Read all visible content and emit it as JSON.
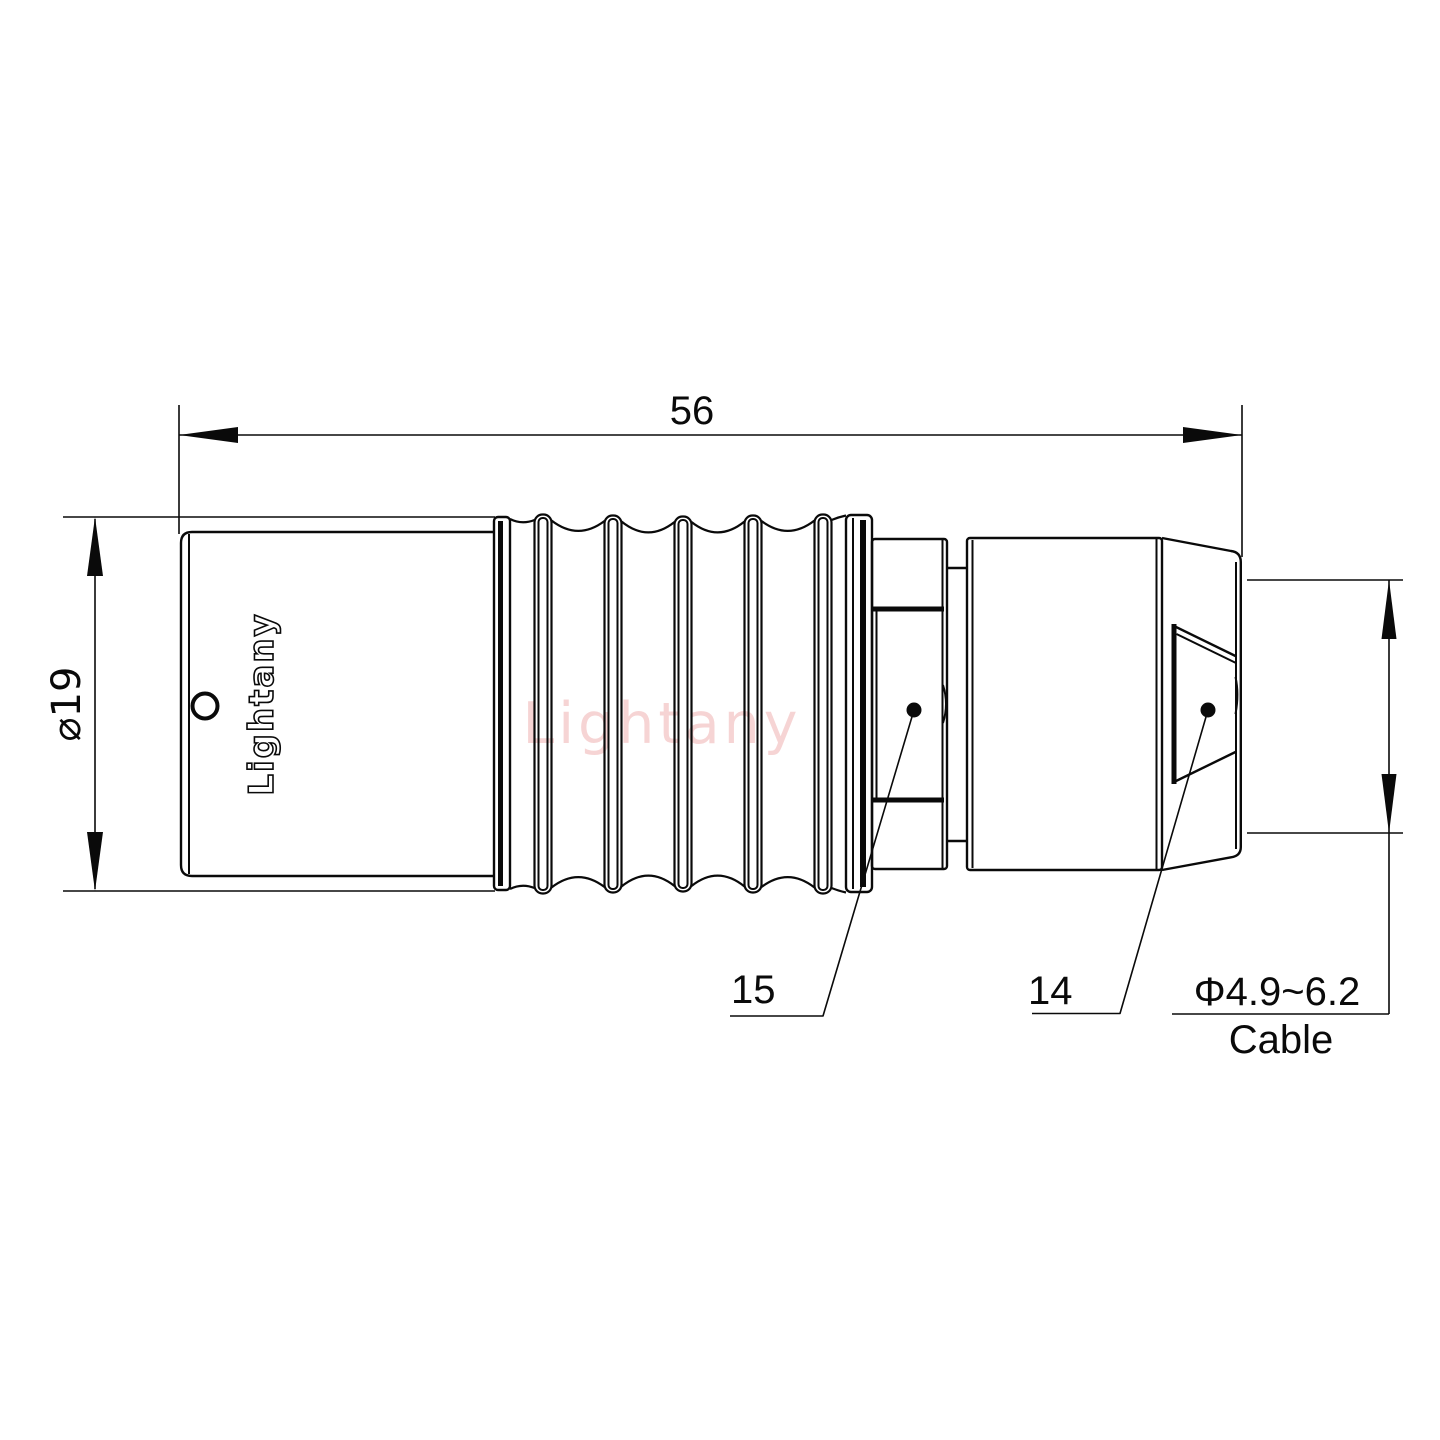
{
  "drawing": {
    "dimensions": {
      "overall_length": "56",
      "outer_diameter": "⌀19",
      "cable_diameter_range": "Φ4.9~6.2",
      "cable_word": "Cable"
    },
    "part_labels": {
      "part_15": "15",
      "part_14": "14"
    },
    "engraving": "Lightany",
    "watermark": "Lightany",
    "colors": {
      "line": "#0a0a0a",
      "watermark": "#efabab",
      "background": "#ffffff"
    }
  }
}
